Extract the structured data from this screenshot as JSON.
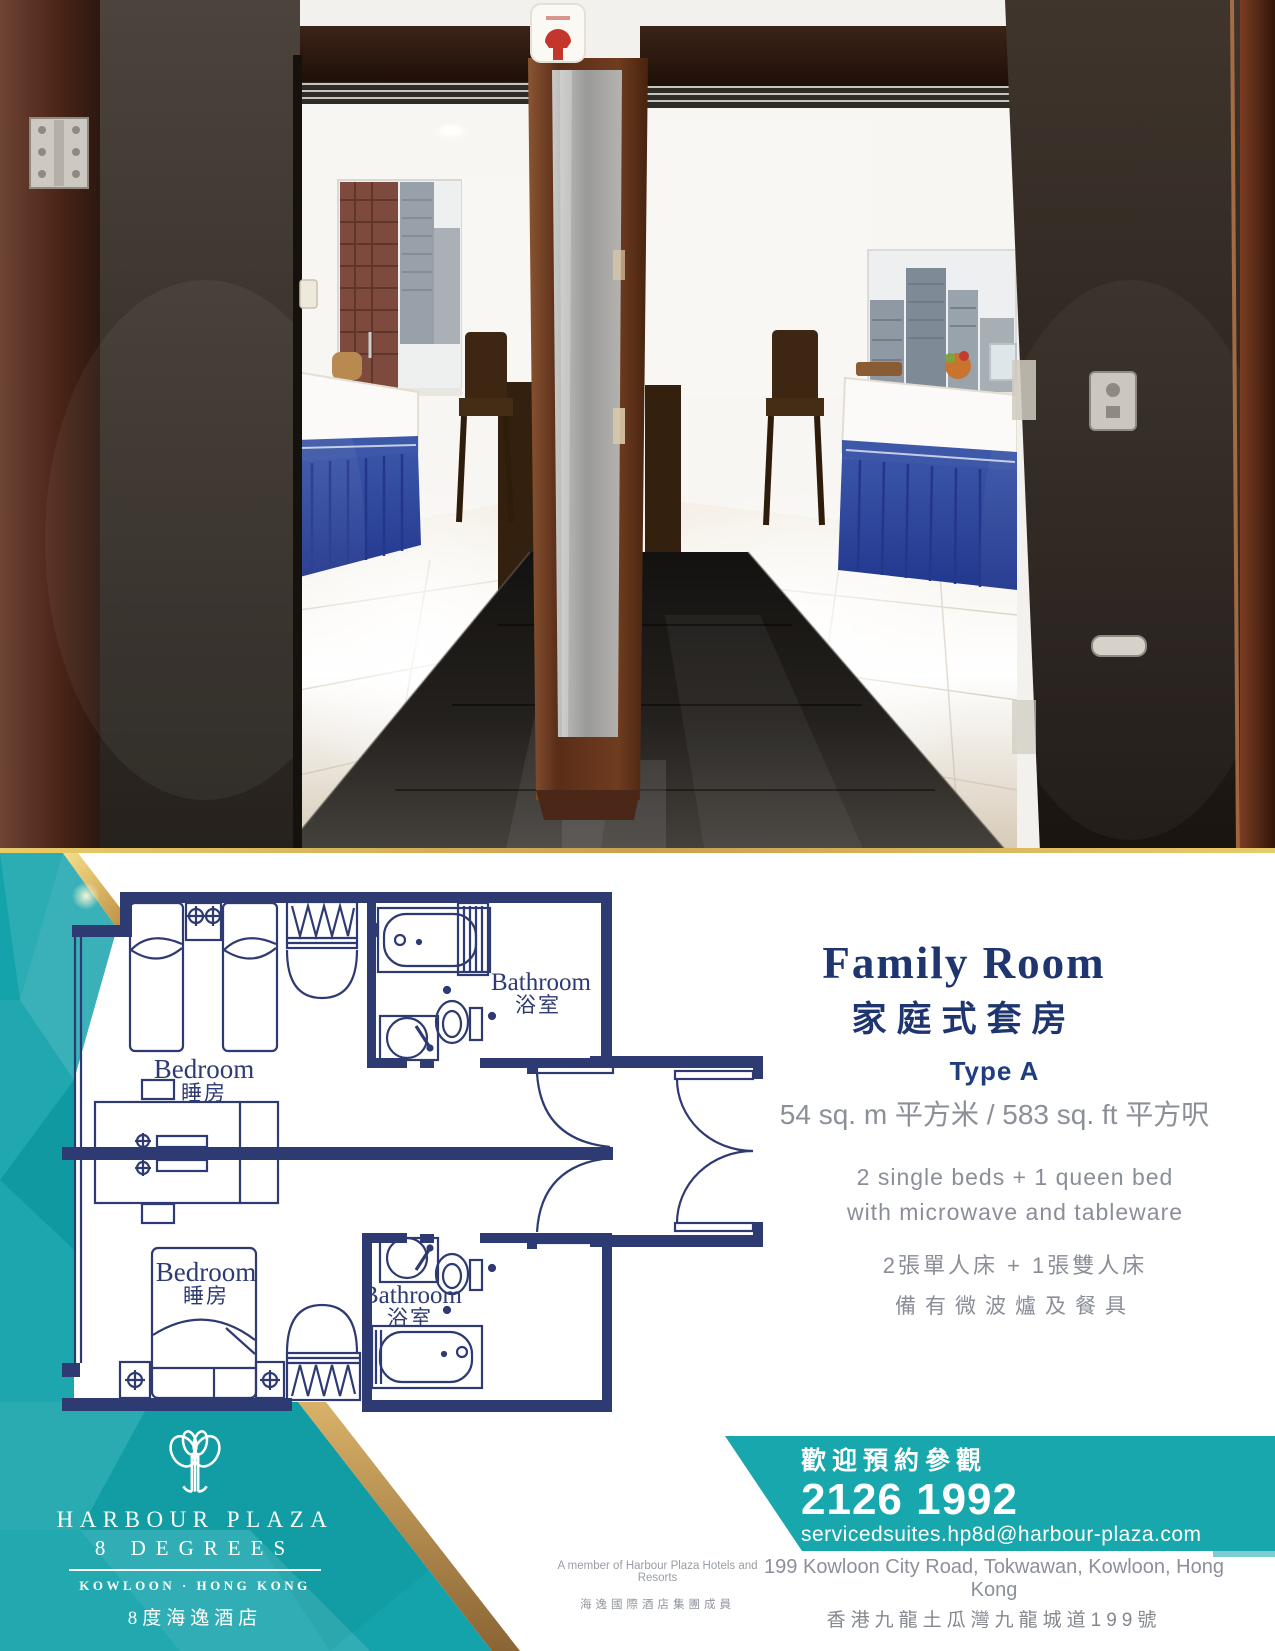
{
  "floor_plan": {
    "bedroom_top": {
      "label_en": "Bedroom",
      "label_zh": "睡房"
    },
    "bedroom_bottom": {
      "label_en": "Bedroom",
      "label_zh": "睡房"
    },
    "bathroom_top": {
      "label_en": "Bathroom",
      "label_zh": "浴室"
    },
    "bathroom_bottom": {
      "label_en": "Bathroom",
      "label_zh": "浴室"
    }
  },
  "room_info": {
    "title_en": "Family Room",
    "title_zh": "家庭式套房",
    "type_label": "Type A",
    "area": "54 sq. m 平方米 / 583 sq. ft 平方呎",
    "features_en": [
      "2 single beds + 1 queen bed",
      "with microwave and tableware"
    ],
    "features_zh": [
      "2張單人床 + 1張雙人床",
      "備有微波爐及餐具"
    ]
  },
  "contact": {
    "invitation_zh": "歡迎預約參觀",
    "phone": "2126 1992",
    "email": "servicedsuites.hp8d@harbour-plaza.com",
    "address_en": "199 Kowloon City Road, Tokwawan, Kowloon, Hong Kong",
    "address_zh": "香港九龍土瓜灣九龍城道199號"
  },
  "logo": {
    "hotel_name_line1": "HARBOUR PLAZA",
    "hotel_name_line2": "8 DEGREES",
    "location": "KOWLOON · HONG KONG",
    "hotel_name_zh": "8度海逸酒店"
  },
  "membership": {
    "line_en": "A member of Harbour Plaza Hotels and Resorts",
    "line_zh": "海逸國際酒店集團成員"
  },
  "colors": {
    "navy": "#2e3a72",
    "title_navy": "#1e356f",
    "teal_banner": "#17a7ad",
    "teal_crystal": "#15a3ab",
    "gold": "#c9a44c",
    "text_gray": "#8b8f98"
  }
}
